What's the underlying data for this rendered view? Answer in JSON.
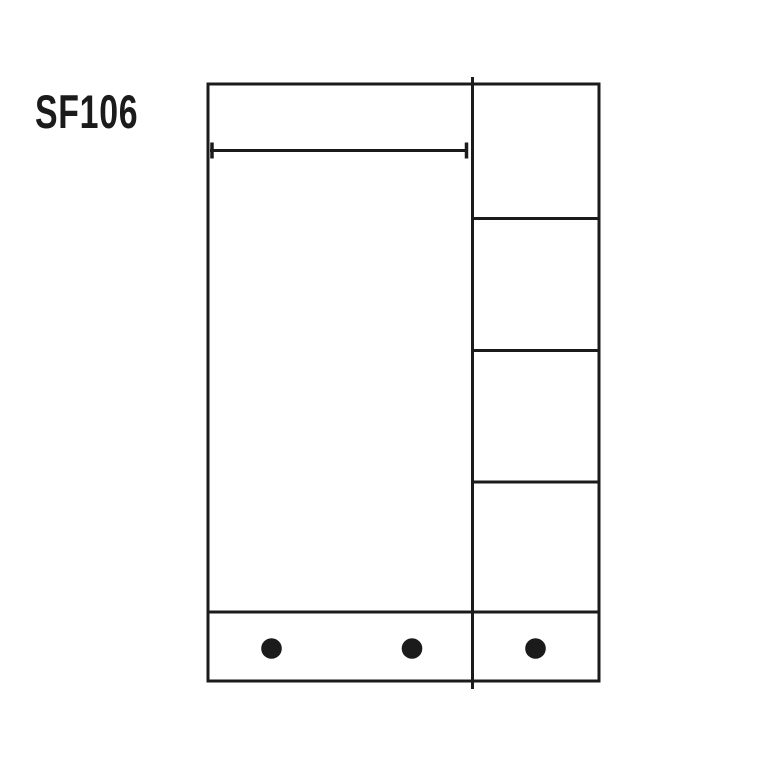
{
  "page": {
    "background_color": "#ffffff",
    "line_color": "#1b1b1b"
  },
  "title": {
    "text": "SF106"
  },
  "diagram": {
    "kind": "wardrobe-front-elevation",
    "right_column_compartments": 4,
    "base_dots": 3,
    "has_width_dimension_line": true
  }
}
